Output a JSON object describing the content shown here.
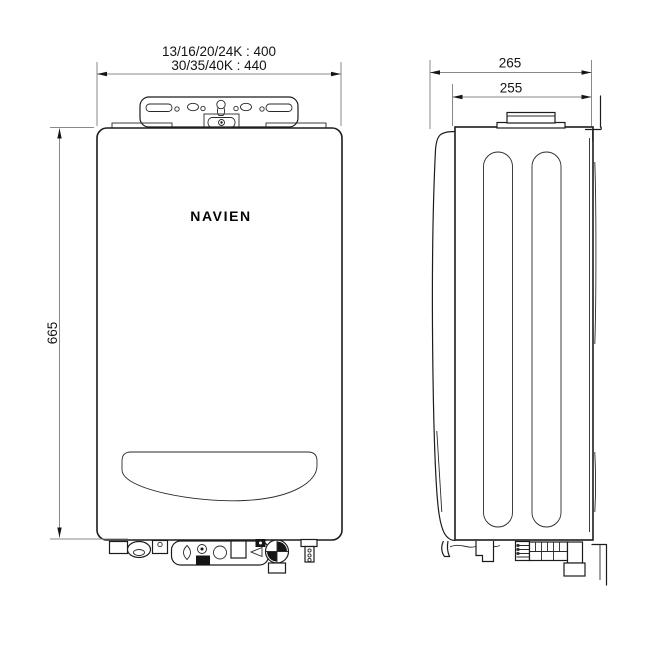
{
  "drawing": {
    "brand": "NAVIEN",
    "front_view": {
      "width_dim_line1": "13/16/20/24K : 400",
      "width_dim_line2": "30/35/40K : 440",
      "height_dim": "665"
    },
    "side_view": {
      "depth_outer_dim": "265",
      "depth_inner_dim": "255"
    },
    "colors": {
      "background": "#ffffff",
      "outline": "#1c1c1c",
      "dimension_line": "#8a8a8a",
      "text": "#141414"
    }
  }
}
